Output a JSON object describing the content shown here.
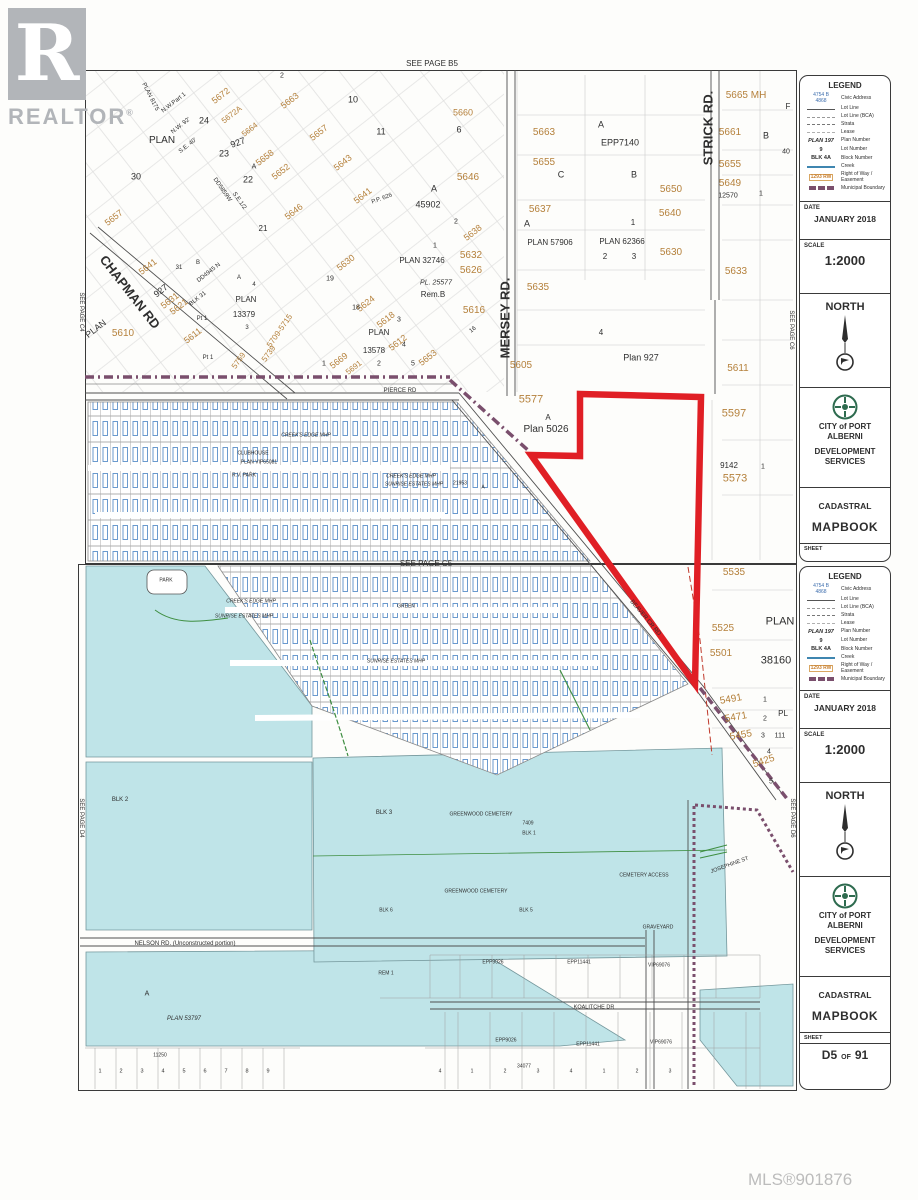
{
  "branding": {
    "logo_letter": "R",
    "logo_word": "REALTOR",
    "logo_reg": "®",
    "mls": "MLS®901876"
  },
  "colors": {
    "parcel_orange": "#b5813c",
    "highlight_red": "#e01f25",
    "water": "#bfe4e8",
    "boundary_purple": "#7a4f6d",
    "legend_blue": "#3f6fae",
    "row_orange": "#c87f2f"
  },
  "sidebar": {
    "legend": {
      "title": "LEGEND",
      "items": [
        {
          "sample": "civic",
          "sample_lines": [
            "4754 B",
            "4868"
          ],
          "label": "Civic Address"
        },
        {
          "sample": "line-solid",
          "label": "Lot Line"
        },
        {
          "sample": "line-dash",
          "label": "Lot Line (BCA)"
        },
        {
          "sample": "line-dash2",
          "label": "Strata"
        },
        {
          "sample": "line-dash3",
          "label": "Lease"
        },
        {
          "sample": "text",
          "sample_text": "PLAN 197",
          "italic": true,
          "label": "Plan Number"
        },
        {
          "sample": "text",
          "sample_text": "9",
          "label": "Lot Number"
        },
        {
          "sample": "text",
          "sample_text": "BLK 4A",
          "label": "Block Number"
        },
        {
          "sample": "creek",
          "label": "Creek"
        },
        {
          "sample": "row",
          "sample_text": "1293 RW",
          "label": "Right of Way / Easement"
        },
        {
          "sample": "muni",
          "label": "Municipal Boundary"
        }
      ]
    },
    "date_label": "DATE",
    "date_value": "JANUARY 2018",
    "scale_label": "SCALE",
    "scale_value": "1:2000",
    "north_label": "NORTH",
    "city_line1": "CITY of PORT ALBERNI",
    "city_line2": "DEVELOPMENT SERVICES",
    "cadastral": "CADASTRAL",
    "mapbook": "MAPBOOK",
    "sheet_label": "SHEET",
    "sheet_num": "D5",
    "sheet_of": "OF",
    "sheet_total": "91"
  },
  "map_labels": [
    {
      "t": "SEE PAGE  B5",
      "x": 432,
      "y": 64,
      "s": 8
    },
    {
      "t": "SEE PAGE C4",
      "x": 81,
      "y": 312,
      "s": 6,
      "r": 90
    },
    {
      "t": "SEE PAGE C6",
      "x": 791,
      "y": 330,
      "s": 6,
      "r": 90
    },
    {
      "t": "CHAPMAN RD",
      "x": 130,
      "y": 292,
      "s": 13,
      "b": 1,
      "r": 52
    },
    {
      "t": "MERSEY RD.",
      "x": 505,
      "y": 318,
      "s": 13,
      "b": 1,
      "r": -90
    },
    {
      "t": "STRICK RD.",
      "x": 708,
      "y": 128,
      "s": 13,
      "b": 1,
      "r": -90
    },
    {
      "t": "PIERCE RD",
      "x": 400,
      "y": 391,
      "s": 6
    },
    {
      "t": "BEAVER CR RD",
      "x": 645,
      "y": 618,
      "s": 6,
      "r": 50
    },
    {
      "t": "PLAN 8175",
      "x": 150,
      "y": 97,
      "s": 6,
      "r": 63
    },
    {
      "t": "N.W.Part 1",
      "x": 174,
      "y": 103,
      "s": 6,
      "r": -38
    },
    {
      "t": "N.W. 92'",
      "x": 181,
      "y": 126,
      "s": 6,
      "r": -38
    },
    {
      "t": "PLAN",
      "x": 162,
      "y": 141,
      "s": 10
    },
    {
      "t": "S.E. 40'",
      "x": 188,
      "y": 146,
      "s": 6,
      "r": -38
    },
    {
      "t": "24",
      "x": 204,
      "y": 121,
      "s": 9
    },
    {
      "t": "23",
      "x": 224,
      "y": 154,
      "s": 9
    },
    {
      "t": "927",
      "x": 238,
      "y": 143,
      "s": 9,
      "r": -20
    },
    {
      "t": "30",
      "x": 136,
      "y": 177,
      "s": 9
    },
    {
      "t": "22",
      "x": 248,
      "y": 180,
      "s": 9
    },
    {
      "t": "21",
      "x": 263,
      "y": 229,
      "s": 8
    },
    {
      "t": "A",
      "x": 254,
      "y": 167,
      "s": 7
    },
    {
      "t": "DD5859W",
      "x": 222,
      "y": 190,
      "s": 6,
      "r": 55
    },
    {
      "t": "S.E.1/2",
      "x": 239,
      "y": 201,
      "s": 6,
      "r": 55
    },
    {
      "t": "2",
      "x": 282,
      "y": 76,
      "s": 7
    },
    {
      "t": "5672",
      "x": 221,
      "y": 96,
      "s": 9,
      "c": "o",
      "r": -38
    },
    {
      "t": "5672A",
      "x": 232,
      "y": 115,
      "s": 8,
      "c": "o",
      "r": -38
    },
    {
      "t": "5663",
      "x": 290,
      "y": 101,
      "s": 9,
      "c": "o",
      "r": -38
    },
    {
      "t": "5664",
      "x": 250,
      "y": 130,
      "s": 8,
      "c": "o",
      "r": -38
    },
    {
      "t": "5658",
      "x": 265,
      "y": 158,
      "s": 9,
      "c": "o",
      "r": -38
    },
    {
      "t": "5652",
      "x": 281,
      "y": 172,
      "s": 9,
      "c": "o",
      "r": -38
    },
    {
      "t": "5646",
      "x": 294,
      "y": 212,
      "s": 9,
      "c": "o",
      "r": -38
    },
    {
      "t": "5657",
      "x": 114,
      "y": 218,
      "s": 9,
      "c": "o",
      "r": -38
    },
    {
      "t": "5641",
      "x": 148,
      "y": 267,
      "s": 9,
      "c": "o",
      "r": -38
    },
    {
      "t": "5657",
      "x": 319,
      "y": 133,
      "s": 9,
      "c": "o",
      "r": -38
    },
    {
      "t": "5643",
      "x": 343,
      "y": 163,
      "s": 9,
      "c": "o",
      "r": -38
    },
    {
      "t": "5641",
      "x": 363,
      "y": 196,
      "s": 9,
      "c": "o",
      "r": -38
    },
    {
      "t": "5660",
      "x": 463,
      "y": 113,
      "s": 9,
      "c": "o"
    },
    {
      "t": "5665 MH",
      "x": 746,
      "y": 96,
      "s": 10,
      "c": "o"
    },
    {
      "t": "5646",
      "x": 468,
      "y": 178,
      "s": 10,
      "c": "o"
    },
    {
      "t": "5638",
      "x": 473,
      "y": 233,
      "s": 9,
      "c": "o",
      "r": -38
    },
    {
      "t": "5632",
      "x": 471,
      "y": 256,
      "s": 10,
      "c": "o"
    },
    {
      "t": "5626",
      "x": 471,
      "y": 271,
      "s": 10,
      "c": "o"
    },
    {
      "t": "5630",
      "x": 346,
      "y": 263,
      "s": 9,
      "c": "o",
      "r": -38
    },
    {
      "t": "5624",
      "x": 366,
      "y": 304,
      "s": 9,
      "c": "o",
      "r": -38
    },
    {
      "t": "5618",
      "x": 386,
      "y": 320,
      "s": 9,
      "c": "o",
      "r": -38
    },
    {
      "t": "5616",
      "x": 474,
      "y": 311,
      "s": 10,
      "c": "o"
    },
    {
      "t": "5612",
      "x": 398,
      "y": 343,
      "s": 9,
      "c": "o",
      "r": -38
    },
    {
      "t": "5653",
      "x": 428,
      "y": 358,
      "s": 9,
      "c": "o",
      "r": -38
    },
    {
      "t": "5669",
      "x": 339,
      "y": 361,
      "s": 9,
      "c": "o",
      "r": -38
    },
    {
      "t": "5691",
      "x": 354,
      "y": 368,
      "s": 8,
      "c": "o",
      "r": -38
    },
    {
      "t": "5610",
      "x": 123,
      "y": 334,
      "s": 10,
      "c": "o"
    },
    {
      "t": "5631",
      "x": 170,
      "y": 301,
      "s": 9,
      "c": "o",
      "r": -38
    },
    {
      "t": "5621",
      "x": 179,
      "y": 307,
      "s": 9,
      "c": "o",
      "r": -38
    },
    {
      "t": "BLK 31",
      "x": 198,
      "y": 299,
      "s": 6,
      "r": -38
    },
    {
      "t": "5611",
      "x": 193,
      "y": 336,
      "s": 9,
      "c": "o",
      "r": -38
    },
    {
      "t": "5709-5715",
      "x": 280,
      "y": 331,
      "s": 8,
      "c": "o",
      "r": -55
    },
    {
      "t": "5739",
      "x": 269,
      "y": 354,
      "s": 8,
      "c": "o",
      "r": -55
    },
    {
      "t": "5759",
      "x": 239,
      "y": 361,
      "s": 8,
      "c": "o",
      "r": -55
    },
    {
      "t": "PLAN",
      "x": 96,
      "y": 329,
      "s": 9,
      "r": -38
    },
    {
      "t": "31",
      "x": 179,
      "y": 268,
      "s": 6
    },
    {
      "t": "B",
      "x": 198,
      "y": 263,
      "s": 6
    },
    {
      "t": "DD4945 N",
      "x": 209,
      "y": 273,
      "s": 6,
      "r": -38
    },
    {
      "t": "927",
      "x": 161,
      "y": 291,
      "s": 9,
      "r": -38
    },
    {
      "t": "A",
      "x": 239,
      "y": 278,
      "s": 6
    },
    {
      "t": "4",
      "x": 254,
      "y": 285,
      "s": 6
    },
    {
      "t": "PLAN",
      "x": 246,
      "y": 300,
      "s": 8
    },
    {
      "t": "13379",
      "x": 244,
      "y": 315,
      "s": 8
    },
    {
      "t": "3",
      "x": 247,
      "y": 328,
      "s": 6
    },
    {
      "t": "Pt 1",
      "x": 202,
      "y": 319,
      "s": 6
    },
    {
      "t": "Pt 1",
      "x": 208,
      "y": 358,
      "s": 6
    },
    {
      "t": "10",
      "x": 353,
      "y": 100,
      "s": 9
    },
    {
      "t": "11",
      "x": 381,
      "y": 132,
      "s": 9
    },
    {
      "t": "6",
      "x": 459,
      "y": 130,
      "s": 9
    },
    {
      "t": "A",
      "x": 434,
      "y": 189,
      "s": 9
    },
    {
      "t": "45902",
      "x": 428,
      "y": 205,
      "s": 9
    },
    {
      "t": "P.P. 626",
      "x": 382,
      "y": 199,
      "s": 6,
      "r": -20
    },
    {
      "t": "2",
      "x": 456,
      "y": 222,
      "s": 7
    },
    {
      "t": "1",
      "x": 435,
      "y": 246,
      "s": 7
    },
    {
      "t": "PLAN 32746",
      "x": 422,
      "y": 261,
      "s": 8
    },
    {
      "t": "PL. 25577",
      "x": 436,
      "y": 283,
      "s": 7,
      "i": 1
    },
    {
      "t": "Rem.B",
      "x": 433,
      "y": 295,
      "s": 8
    },
    {
      "t": "19",
      "x": 330,
      "y": 279,
      "s": 7
    },
    {
      "t": "18",
      "x": 356,
      "y": 308,
      "s": 7
    },
    {
      "t": "3",
      "x": 399,
      "y": 320,
      "s": 7
    },
    {
      "t": "16",
      "x": 473,
      "y": 330,
      "s": 6,
      "r": -38
    },
    {
      "t": "PLAN",
      "x": 379,
      "y": 333,
      "s": 8
    },
    {
      "t": "13578",
      "x": 374,
      "y": 351,
      "s": 8
    },
    {
      "t": "2",
      "x": 379,
      "y": 364,
      "s": 7
    },
    {
      "t": "5",
      "x": 413,
      "y": 364,
      "s": 7
    },
    {
      "t": "1",
      "x": 324,
      "y": 364,
      "s": 7
    },
    {
      "t": "4",
      "x": 404,
      "y": 345,
      "s": 7
    },
    {
      "t": "5663",
      "x": 544,
      "y": 133,
      "s": 10,
      "c": "o"
    },
    {
      "t": "A",
      "x": 601,
      "y": 125,
      "s": 9
    },
    {
      "t": "EPP7140",
      "x": 620,
      "y": 143,
      "s": 9
    },
    {
      "t": "5655",
      "x": 544,
      "y": 163,
      "s": 10,
      "c": "o"
    },
    {
      "t": "C",
      "x": 561,
      "y": 175,
      "s": 9
    },
    {
      "t": "B",
      "x": 634,
      "y": 175,
      "s": 9
    },
    {
      "t": "5650",
      "x": 671,
      "y": 190,
      "s": 10,
      "c": "o"
    },
    {
      "t": "5661",
      "x": 730,
      "y": 133,
      "s": 10,
      "c": "o"
    },
    {
      "t": "B",
      "x": 766,
      "y": 136,
      "s": 9
    },
    {
      "t": "40",
      "x": 786,
      "y": 152,
      "s": 7
    },
    {
      "t": "5655",
      "x": 730,
      "y": 165,
      "s": 10,
      "c": "o"
    },
    {
      "t": "5649",
      "x": 730,
      "y": 184,
      "s": 10,
      "c": "o"
    },
    {
      "t": "12570",
      "x": 728,
      "y": 196,
      "s": 7
    },
    {
      "t": "1",
      "x": 761,
      "y": 194,
      "s": 7
    },
    {
      "t": "F",
      "x": 788,
      "y": 107,
      "s": 8
    },
    {
      "t": "5637",
      "x": 540,
      "y": 210,
      "s": 10,
      "c": "o"
    },
    {
      "t": "A",
      "x": 527,
      "y": 224,
      "s": 9
    },
    {
      "t": "PLAN 57906",
      "x": 550,
      "y": 243,
      "s": 8
    },
    {
      "t": "1",
      "x": 633,
      "y": 223,
      "s": 8
    },
    {
      "t": "PLAN 62366",
      "x": 622,
      "y": 242,
      "s": 8
    },
    {
      "t": "2",
      "x": 605,
      "y": 257,
      "s": 8
    },
    {
      "t": "3",
      "x": 634,
      "y": 257,
      "s": 8
    },
    {
      "t": "5640",
      "x": 670,
      "y": 214,
      "s": 10,
      "c": "o"
    },
    {
      "t": "5630",
      "x": 671,
      "y": 253,
      "s": 10,
      "c": "o"
    },
    {
      "t": "5635",
      "x": 538,
      "y": 288,
      "s": 10,
      "c": "o"
    },
    {
      "t": "5633",
      "x": 736,
      "y": 272,
      "s": 10,
      "c": "o"
    },
    {
      "t": "4",
      "x": 601,
      "y": 333,
      "s": 8
    },
    {
      "t": "Plan 927",
      "x": 641,
      "y": 358,
      "s": 9
    },
    {
      "t": "5611",
      "x": 738,
      "y": 369,
      "s": 10,
      "c": "o"
    },
    {
      "t": "5605",
      "x": 521,
      "y": 366,
      "s": 10,
      "c": "o"
    },
    {
      "t": "5577",
      "x": 531,
      "y": 400,
      "s": 11,
      "c": "o"
    },
    {
      "t": "A",
      "x": 548,
      "y": 418,
      "s": 8
    },
    {
      "t": "Plan 5026",
      "x": 546,
      "y": 430,
      "s": 10
    },
    {
      "t": "5597",
      "x": 734,
      "y": 414,
      "s": 11,
      "c": "o"
    },
    {
      "t": "9142",
      "x": 729,
      "y": 466,
      "s": 8
    },
    {
      "t": "1",
      "x": 763,
      "y": 467,
      "s": 7
    },
    {
      "t": "5573",
      "x": 735,
      "y": 479,
      "s": 11,
      "c": "o"
    },
    {
      "t": "CREEK'S EDGE MHP",
      "x": 306,
      "y": 436,
      "s": 5,
      "i": 1
    },
    {
      "t": "CLUBHOUSE",
      "x": 253,
      "y": 454,
      "s": 5
    },
    {
      "t": "PLAN VIP65081",
      "x": 259,
      "y": 463,
      "s": 5
    },
    {
      "t": "R.V. PARK",
      "x": 244,
      "y": 476,
      "s": 5
    },
    {
      "t": "CREEK'S EDGE MHP",
      "x": 411,
      "y": 477,
      "s": 5,
      "i": 1
    },
    {
      "t": "SUNRISE ESTATES MHP",
      "x": 414,
      "y": 485,
      "s": 5,
      "i": 1
    },
    {
      "t": "21953",
      "x": 460,
      "y": 484,
      "s": 5
    },
    {
      "t": "A",
      "x": 483,
      "y": 488,
      "s": 5
    },
    {
      "t": "SEE PAGE  C5",
      "x": 426,
      "y": 564,
      "s": 8
    },
    {
      "t": "SEE PAGE D4",
      "x": 81,
      "y": 818,
      "s": 6,
      "r": 90
    },
    {
      "t": "SEE PAGE D6",
      "x": 792,
      "y": 818,
      "s": 6,
      "r": 90
    },
    {
      "t": "PARK",
      "x": 166,
      "y": 581,
      "s": 5
    },
    {
      "t": "CREEK'S EDGE MHP",
      "x": 251,
      "y": 602,
      "s": 5,
      "i": 1
    },
    {
      "t": "SUNRISE ESTATES MHP",
      "x": 244,
      "y": 617,
      "s": 5,
      "i": 1
    },
    {
      "t": "GREEN",
      "x": 406,
      "y": 607,
      "s": 5
    },
    {
      "t": "SUNRISE ESTATES MHP",
      "x": 396,
      "y": 662,
      "s": 5,
      "i": 1
    },
    {
      "t": "BLK 2",
      "x": 120,
      "y": 800,
      "s": 6
    },
    {
      "t": "BLK 3",
      "x": 384,
      "y": 813,
      "s": 6
    },
    {
      "t": "GREENWOOD CEMETERY",
      "x": 481,
      "y": 815,
      "s": 5
    },
    {
      "t": "7409",
      "x": 528,
      "y": 824,
      "s": 5
    },
    {
      "t": "BLK 1",
      "x": 529,
      "y": 834,
      "s": 5
    },
    {
      "t": "GREENWOOD CEMETERY",
      "x": 476,
      "y": 892,
      "s": 5
    },
    {
      "t": "BLK 6",
      "x": 386,
      "y": 911,
      "s": 5
    },
    {
      "t": "BLK 5",
      "x": 526,
      "y": 911,
      "s": 5
    },
    {
      "t": "CEMETERY ACCESS",
      "x": 644,
      "y": 876,
      "s": 5
    },
    {
      "t": "GRAVEYARD",
      "x": 658,
      "y": 928,
      "s": 5
    },
    {
      "t": "JOSEPHINE ST",
      "x": 730,
      "y": 866,
      "s": 5.5,
      "r": -20
    },
    {
      "t": "NELSON  RD.  (Unconstructed portion)",
      "x": 185,
      "y": 944,
      "s": 6
    },
    {
      "t": "A",
      "x": 147,
      "y": 994,
      "s": 7
    },
    {
      "t": "PLAN 53797",
      "x": 184,
      "y": 1019,
      "s": 6,
      "i": 1
    },
    {
      "t": "11250",
      "x": 160,
      "y": 1056,
      "s": 5
    },
    {
      "t": "1",
      "x": 100,
      "y": 1072,
      "s": 5.5
    },
    {
      "t": "2",
      "x": 121,
      "y": 1072,
      "s": 5.5
    },
    {
      "t": "3",
      "x": 142,
      "y": 1072,
      "s": 5.5
    },
    {
      "t": "4",
      "x": 163,
      "y": 1072,
      "s": 5.5
    },
    {
      "t": "5",
      "x": 184,
      "y": 1072,
      "s": 5.5
    },
    {
      "t": "6",
      "x": 205,
      "y": 1072,
      "s": 5.5
    },
    {
      "t": "7",
      "x": 226,
      "y": 1072,
      "s": 5.5
    },
    {
      "t": "8",
      "x": 247,
      "y": 1072,
      "s": 5.5
    },
    {
      "t": "9",
      "x": 268,
      "y": 1072,
      "s": 5.5
    },
    {
      "t": "REM 1",
      "x": 386,
      "y": 974,
      "s": 5
    },
    {
      "t": "EPP9026",
      "x": 493,
      "y": 963,
      "s": 5
    },
    {
      "t": "EPP11441",
      "x": 579,
      "y": 963,
      "s": 5
    },
    {
      "t": "VIP69076",
      "x": 659,
      "y": 966,
      "s": 5
    },
    {
      "t": "KOALITCHE  DR",
      "x": 594,
      "y": 1008,
      "s": 5.5
    },
    {
      "t": "EPP9026",
      "x": 506,
      "y": 1041,
      "s": 5
    },
    {
      "t": "EPP11441",
      "x": 588,
      "y": 1045,
      "s": 5
    },
    {
      "t": "VIP69076",
      "x": 661,
      "y": 1043,
      "s": 5
    },
    {
      "t": "34077",
      "x": 524,
      "y": 1067,
      "s": 5
    },
    {
      "t": "4",
      "x": 440,
      "y": 1072,
      "s": 5
    },
    {
      "t": "1",
      "x": 472,
      "y": 1072,
      "s": 5
    },
    {
      "t": "2",
      "x": 505,
      "y": 1072,
      "s": 5
    },
    {
      "t": "3",
      "x": 538,
      "y": 1072,
      "s": 5
    },
    {
      "t": "4",
      "x": 571,
      "y": 1072,
      "s": 5
    },
    {
      "t": "1",
      "x": 604,
      "y": 1072,
      "s": 5
    },
    {
      "t": "2",
      "x": 637,
      "y": 1072,
      "s": 5
    },
    {
      "t": "3",
      "x": 670,
      "y": 1072,
      "s": 5
    },
    {
      "t": "5535",
      "x": 734,
      "y": 573,
      "s": 10,
      "c": "o"
    },
    {
      "t": "5525",
      "x": 723,
      "y": 629,
      "s": 10,
      "c": "o"
    },
    {
      "t": "PLAN",
      "x": 780,
      "y": 622,
      "s": 11
    },
    {
      "t": "5501",
      "x": 721,
      "y": 654,
      "s": 10,
      "c": "o"
    },
    {
      "t": "38160",
      "x": 776,
      "y": 661,
      "s": 11
    },
    {
      "t": "5491",
      "x": 731,
      "y": 700,
      "s": 10,
      "c": "o",
      "r": -10
    },
    {
      "t": "1",
      "x": 765,
      "y": 700,
      "s": 7
    },
    {
      "t": "5471",
      "x": 736,
      "y": 718,
      "s": 10,
      "c": "o",
      "r": -10
    },
    {
      "t": "2",
      "x": 765,
      "y": 719,
      "s": 7
    },
    {
      "t": "PL",
      "x": 783,
      "y": 714,
      "s": 8
    },
    {
      "t": "5455",
      "x": 741,
      "y": 736,
      "s": 10,
      "c": "o",
      "r": -10
    },
    {
      "t": "3",
      "x": 763,
      "y": 736,
      "s": 7
    },
    {
      "t": "111",
      "x": 780,
      "y": 736,
      "s": 7
    },
    {
      "t": "4",
      "x": 769,
      "y": 752,
      "s": 7
    },
    {
      "t": "5425",
      "x": 764,
      "y": 762,
      "s": 10,
      "c": "o",
      "r": -18
    },
    {
      "t": "5",
      "x": 771,
      "y": 782,
      "s": 7
    }
  ]
}
